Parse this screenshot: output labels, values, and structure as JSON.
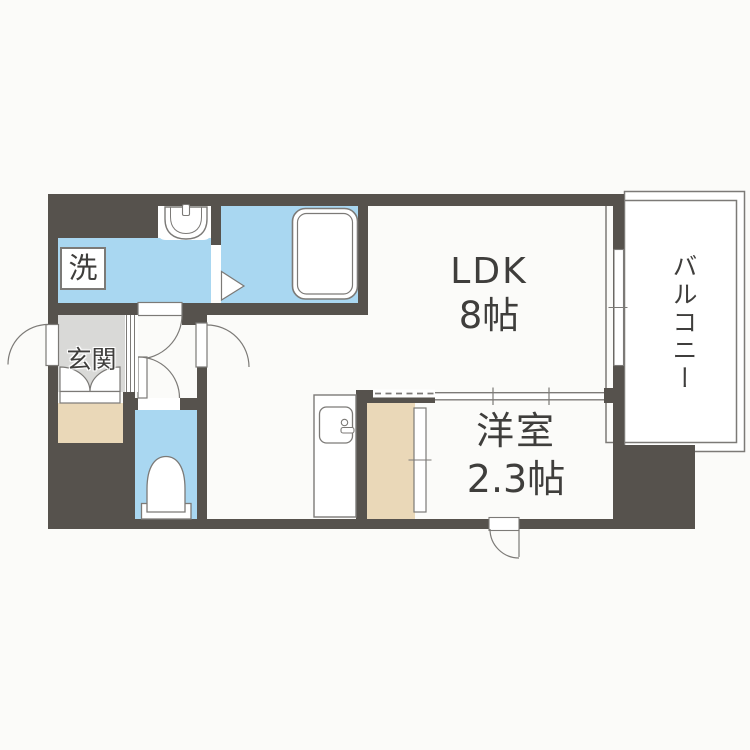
{
  "plan": {
    "rooms": {
      "ldk": {
        "line1": "LDK",
        "line2": "8帖"
      },
      "western_room": {
        "line1": "洋室",
        "line2": "2.3帖"
      },
      "balcony": {
        "label": "バルコニー"
      },
      "entrance": {
        "label": "玄関"
      },
      "laundry": {
        "label": "洗"
      }
    },
    "fixtures": {
      "bathtub": "bathtub-icon",
      "washbasin": "washbasin-icon",
      "toilet": "toilet-icon",
      "kitchen_sink": "kitchen-sink-icon",
      "entrance_door": "door-swing-icon",
      "room_doors": "door-swing-icon",
      "partition": "sliding-door-icon",
      "balcony_window": "window-icon",
      "shoe_cabinet": "double-door-icon"
    },
    "colors": {
      "wall": "#56524d",
      "water": "#a9d7f1",
      "beige": "#ead8b8",
      "gray": "#d9d9d7",
      "line": "#7c7a77",
      "text": "#3f3e3c",
      "bg": "#fbfbf9"
    }
  }
}
